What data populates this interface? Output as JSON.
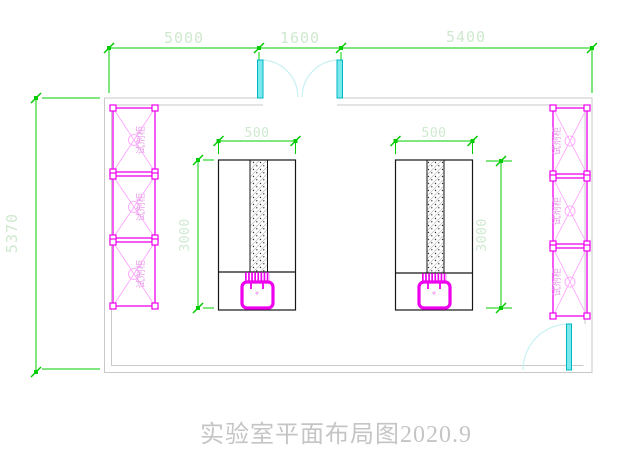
{
  "drawing": {
    "title": "实验室平面布局图2020.9",
    "dims": {
      "top_left": "5000",
      "top_middle": "1600",
      "top_right": "5400",
      "left_height": "5370",
      "bench_width": "500",
      "bench_depth": "3000"
    },
    "cabinet_label": "试剂柜",
    "colors": {
      "dimension_line": "#00cc00",
      "dimension_text": "#cfe9cf",
      "cabinet_magenta": "#ee00ee",
      "door_cyan": "#79e9ec",
      "wall_gray": "#c9c9c9",
      "bench_black": "#161616",
      "title_gray": "#c5c5c5"
    }
  }
}
